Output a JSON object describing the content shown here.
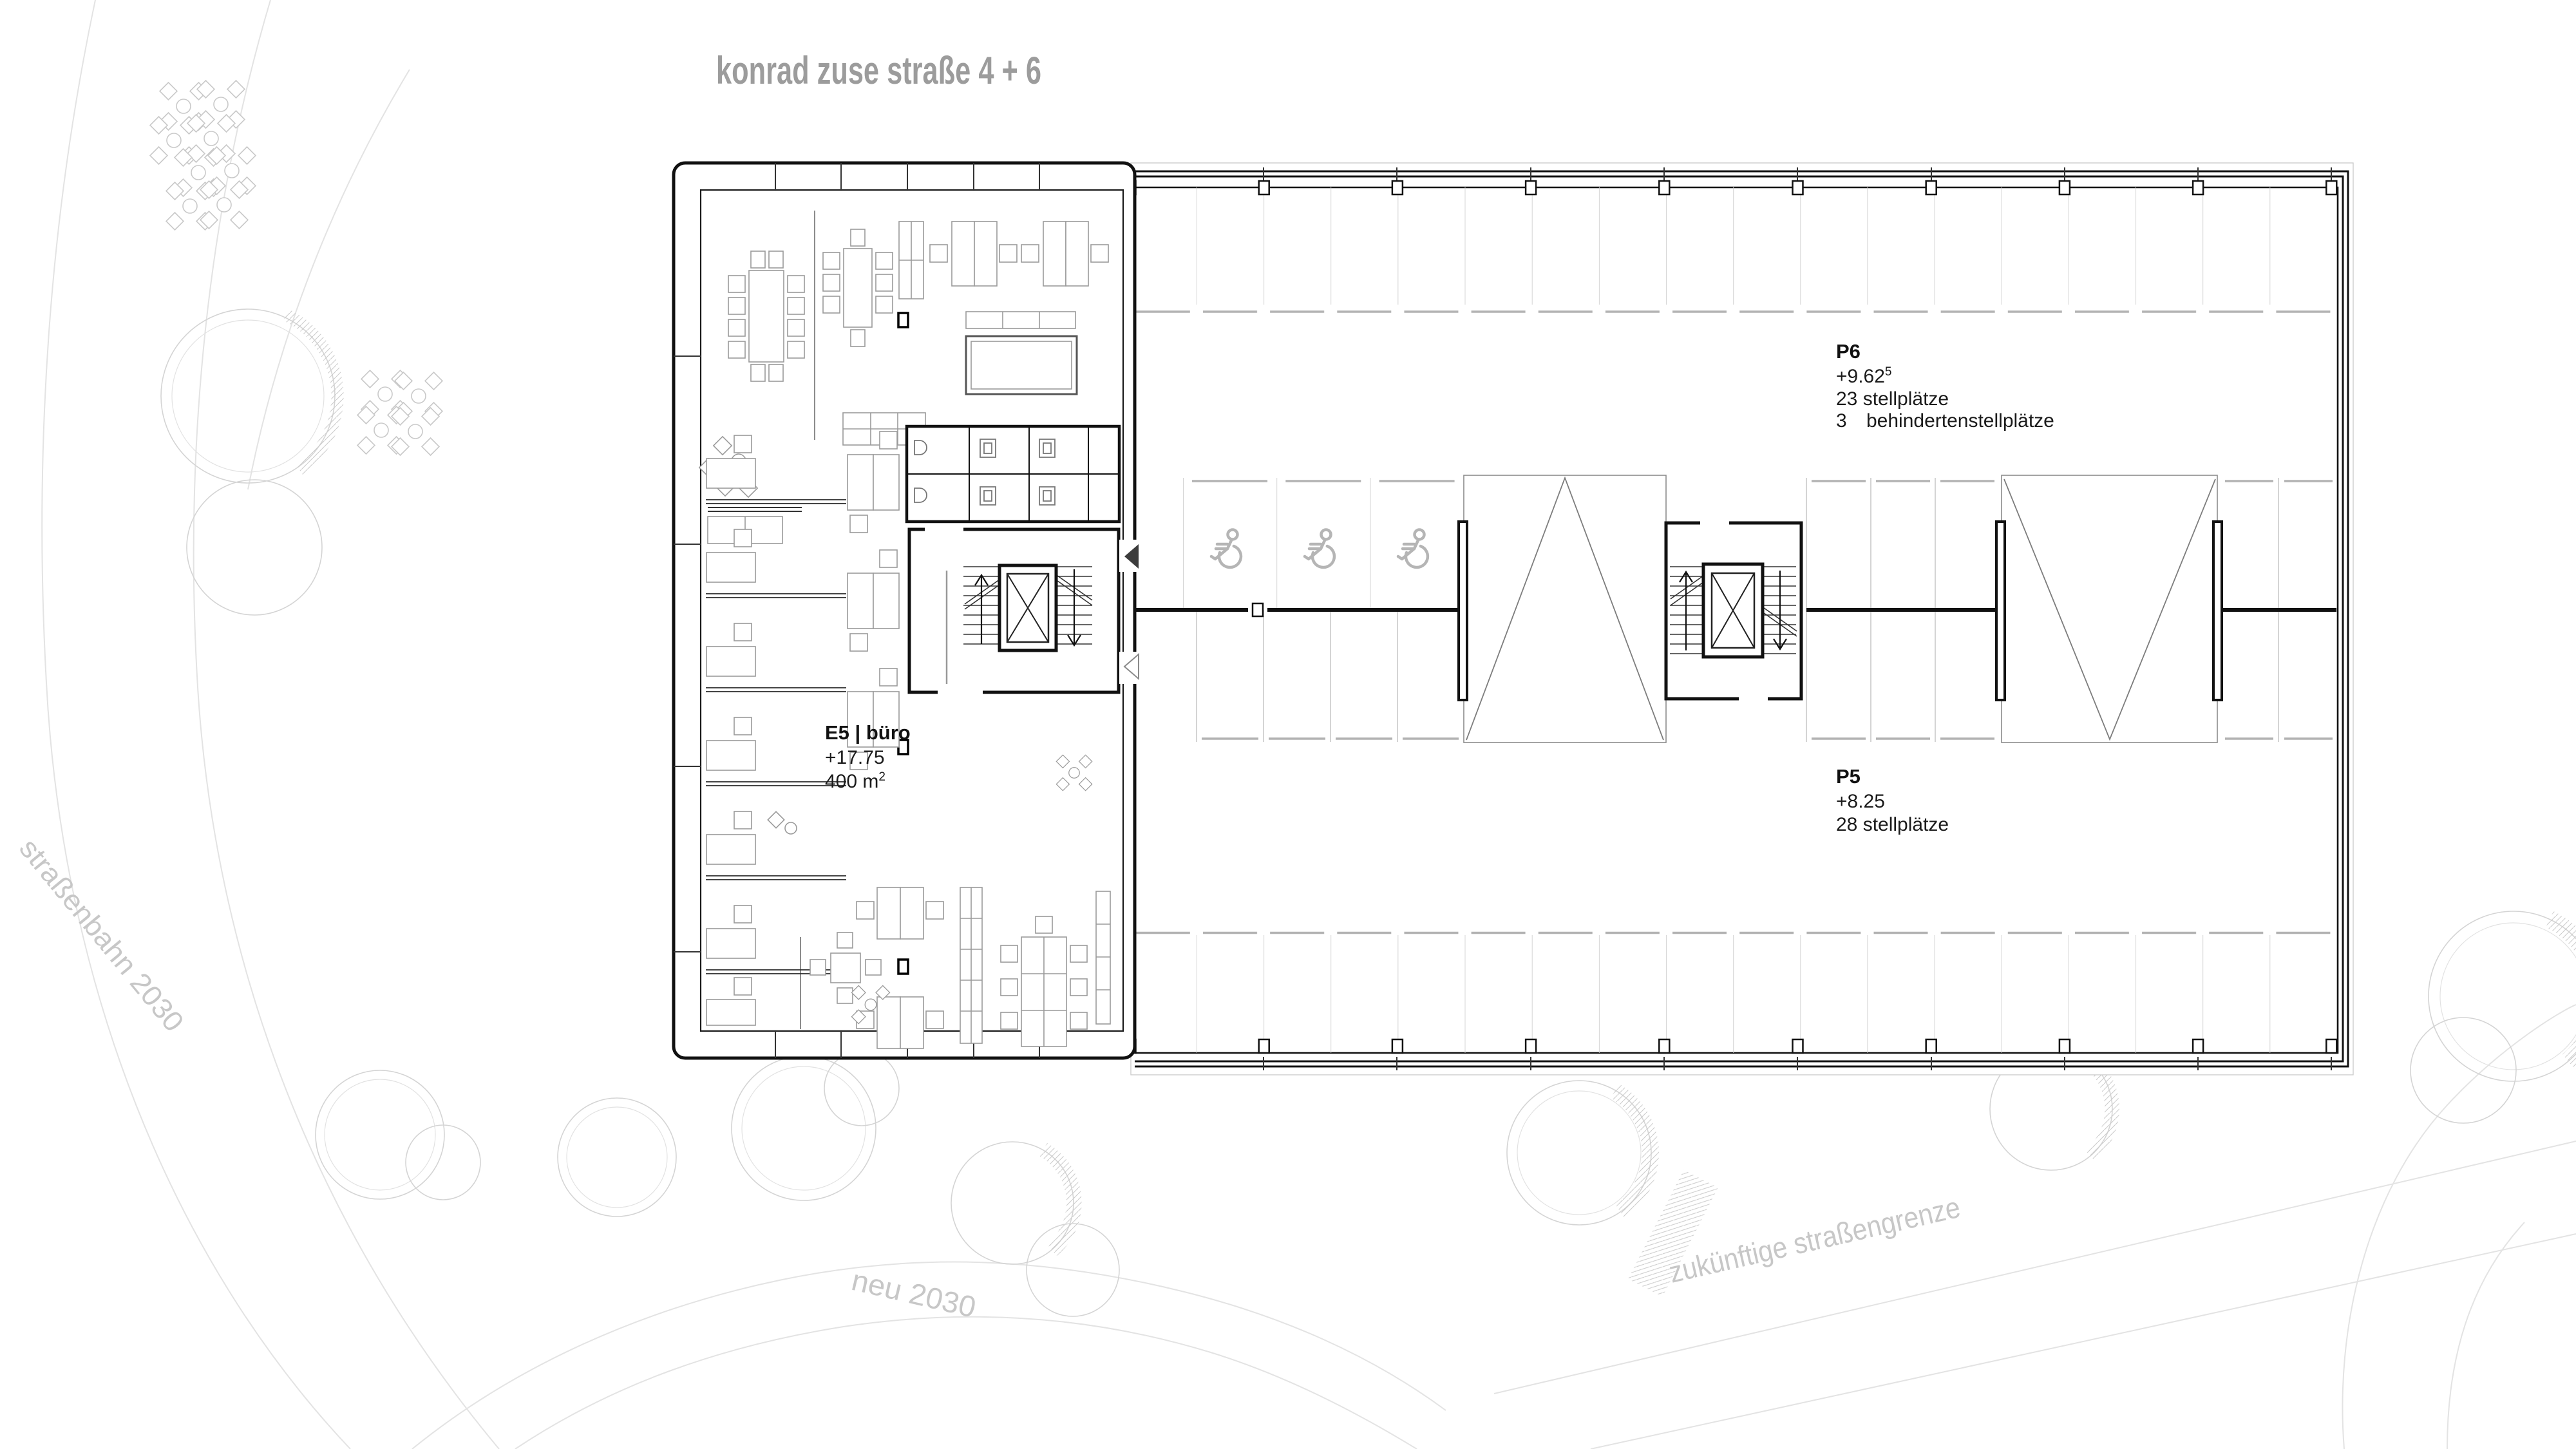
{
  "title": "konrad zuse straße 4 + 6",
  "office": {
    "name": "E5 | büro",
    "level": "+17.75",
    "area": "400 m",
    "area_sup": "2"
  },
  "parking_upper": {
    "name": "P6",
    "level": "+9.62",
    "level_sup": "5",
    "stalls": "23 stellplätze",
    "accessible_count": "3",
    "accessible_label": "behindertenstellplätze"
  },
  "parking_lower": {
    "name": "P5",
    "level": "+8.25",
    "stalls": "28 stellplätze"
  },
  "site_labels": {
    "tram": "straßenbahn 2030",
    "new_road": "neu 2030",
    "future_boundary": "zukünftige straßengrenze"
  },
  "colors": {
    "plan_line": "#111111",
    "furniture": "#9a9a9a",
    "parking_divider": "#c9c9c9",
    "wheel_stop": "#b3b3b3",
    "site_line": "#e3e3e3",
    "site_text": "#c7c7c7",
    "title_text": "#9c9c9c"
  },
  "icons": {
    "wheelchair": "wheelchair-icon",
    "elevator": "elevator-x-icon",
    "entrance_filled": "entrance-arrow-filled-icon",
    "entrance_outline": "entrance-arrow-outline-icon",
    "tree": "tree-icon",
    "plant": "plant-icon"
  }
}
